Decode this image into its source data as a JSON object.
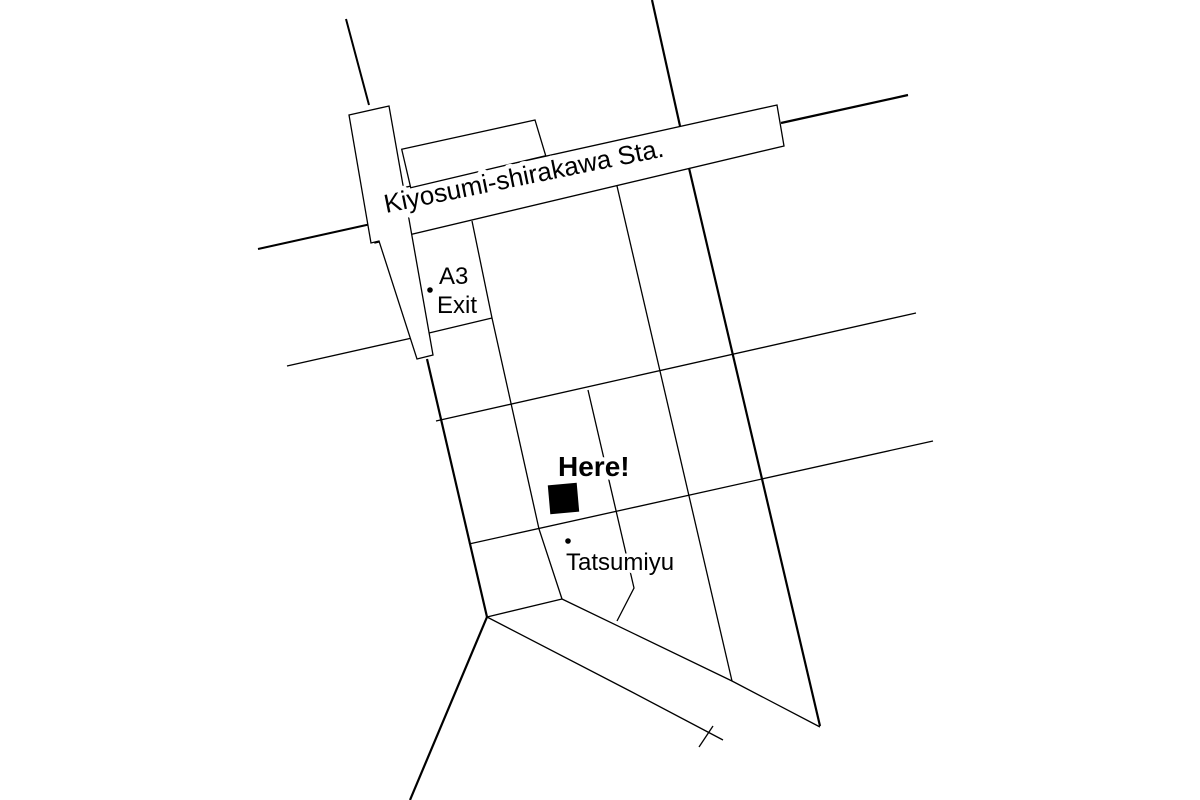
{
  "map": {
    "background_color": "#ffffff",
    "line_color": "#000000",
    "marker_color": "#000000",
    "station": {
      "label": "Kiyosumi-shirakawa Sta.",
      "building_main": "366,196 777,105 784,146 375,243",
      "building_annex": "401.7,149.3 535,120 545.7,155.7 410.7,187.7",
      "crossing_bar": "349,115 389,106 433,355 417,359 379,241 371,243",
      "outline_width": 1.3
    },
    "roads": [
      {
        "name": "road-top-left",
        "points": "346,19 369,105",
        "width": 2
      },
      {
        "name": "road-main-north",
        "points": "652,0 680,126",
        "width": 2.2
      },
      {
        "name": "road-main-south",
        "points": "689,168 820,726",
        "width": 2.2
      },
      {
        "name": "road-northeast",
        "points": "781,123 908,95",
        "width": 2.2
      },
      {
        "name": "road-west-upper",
        "points": "258,249 371,224",
        "width": 2
      },
      {
        "name": "road-west-lower",
        "points": "287,366 412,338",
        "width": 1.3
      },
      {
        "name": "road-exit-block-south",
        "points": "429,333 492,318",
        "width": 1.3
      },
      {
        "name": "road-block-west",
        "points": "472,221 492,318 539,529 562,599",
        "width": 1.3
      },
      {
        "name": "road-block-middle",
        "points": "588,390 634,588 617,621",
        "width": 1.3
      },
      {
        "name": "road-block-east",
        "points": "617,186 732,681",
        "width": 1.3
      },
      {
        "name": "road-cross-upper",
        "points": "436,421 916,313",
        "width": 1.3
      },
      {
        "name": "road-cross-lower",
        "points": "469,544 933,441",
        "width": 1.3
      },
      {
        "name": "road-center",
        "points": "427,359 487,617",
        "width": 2.2
      },
      {
        "name": "road-southwest",
        "points": "487,617 410,800",
        "width": 2.2
      },
      {
        "name": "river-band-cap",
        "points": "487,617 562,599",
        "width": 1.3
      },
      {
        "name": "river-band-top",
        "points": "562,599 732,681 820,727",
        "width": 1.3
      },
      {
        "name": "river-band-bottom",
        "points": "487,617 630,691 723,740",
        "width": 1.3
      },
      {
        "name": "river-band-tick",
        "points": "713,726 699,747",
        "width": 1.3
      }
    ],
    "markers": {
      "exit": {
        "line1": "A3",
        "line2": "Exit",
        "dot": {
          "x": 430,
          "y": 290,
          "r": 2.8
        }
      },
      "here": {
        "label": "Here!",
        "square": {
          "x": 549,
          "y": 484,
          "size": 29,
          "rotation": -5
        }
      },
      "tatsumiyu": {
        "label": "Tatsumiyu",
        "dot": {
          "x": 568,
          "y": 541,
          "r": 2.8
        }
      }
    }
  }
}
